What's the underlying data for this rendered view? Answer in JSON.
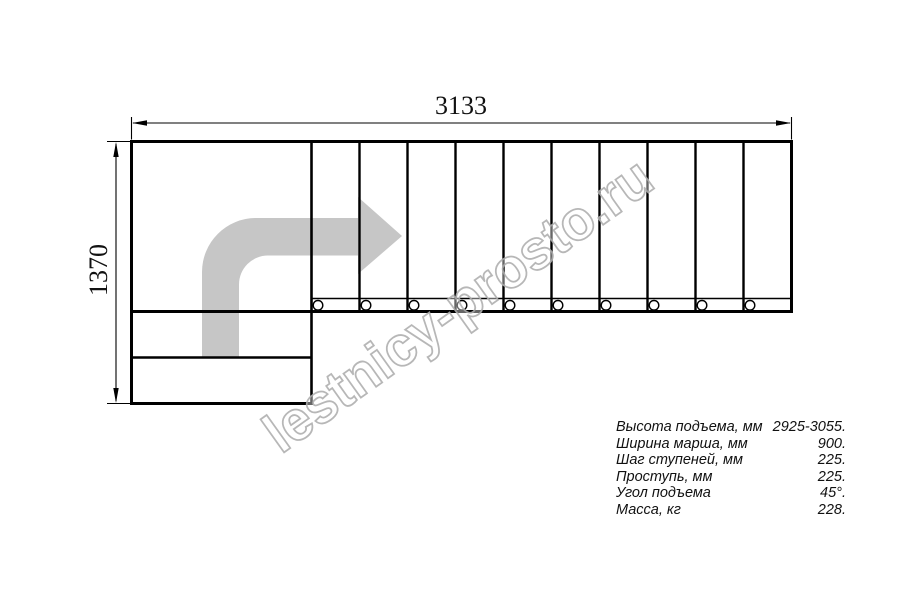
{
  "drawing": {
    "title": "staircase-plan-top-view",
    "dimensions": {
      "width_label": "3133",
      "height_label": "1370"
    },
    "treads": {
      "count": 10,
      "bolt_circles": 10
    },
    "arrow": {
      "name": "walk-direction-arrow",
      "shape": "quarter-turn-up-then-right"
    }
  },
  "watermark": {
    "text": "lestnicy-prosto.ru"
  },
  "specs": {
    "rows": [
      {
        "label": "Высота подъема, мм",
        "value": "2925-3055."
      },
      {
        "label": "Ширина марша, мм",
        "value": "900."
      },
      {
        "label": "Шаг ступеней, мм",
        "value": "225."
      },
      {
        "label": "Проступь, мм",
        "value": "225."
      },
      {
        "label": "Угол подъема",
        "value": "45°."
      },
      {
        "label": "Масса, кг",
        "value": "228."
      }
    ]
  },
  "colors": {
    "line": "#000000",
    "arrow_fill": "#c6c6c6",
    "watermark_stroke": "#b0b0b0"
  }
}
